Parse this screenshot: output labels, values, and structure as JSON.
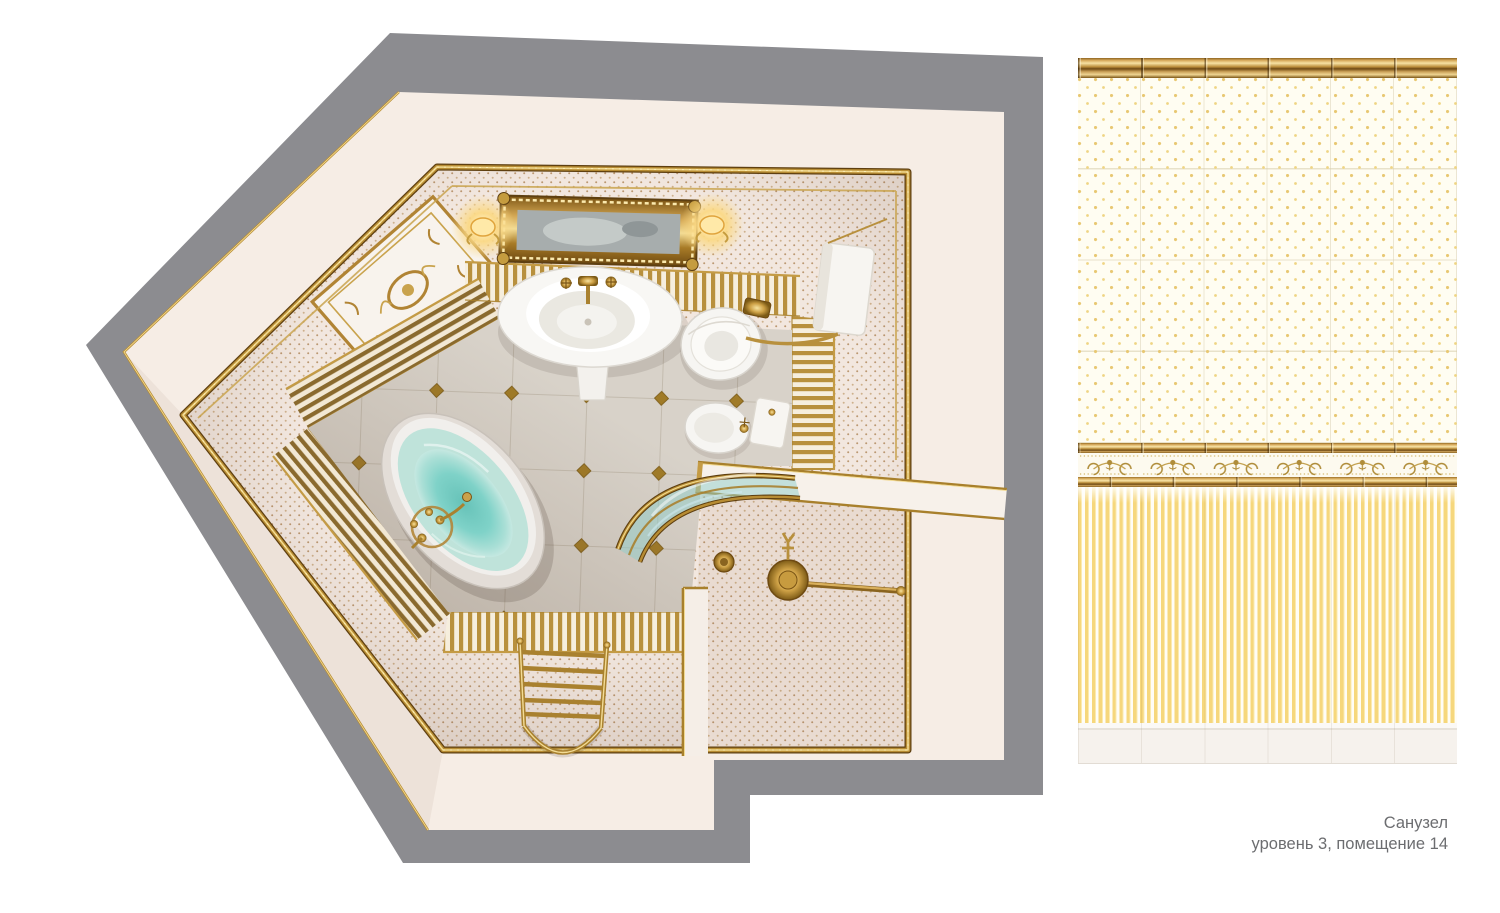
{
  "title_block": {
    "room_name": "Санузел",
    "location": "уровень 3, помещение 14"
  },
  "plan": {
    "type": "top-down-3d-render",
    "room": "bathroom",
    "fixtures": [
      "bathtub",
      "bath-mixer",
      "pedestal-sink",
      "ornate-wall-mirror",
      "sconce-left",
      "sconce-right",
      "toilet",
      "wall-cistern",
      "bidet",
      "shower-enclosure-curved-glass",
      "shower-head",
      "floor-drain",
      "heated-towel-rail",
      "decorative-wall-panel",
      "doorway"
    ]
  },
  "tile_panel": {
    "columns": 6,
    "sections": [
      "gold-molding",
      "dotted-field",
      "ornament-frieze",
      "striped-field",
      "baseboard"
    ]
  },
  "palette": {
    "roof_gray": "#8c8c90",
    "wall_white": "#f6ede5",
    "gold_trim": "#b78c33",
    "gold_dark": "#5e3f10",
    "gold_light": "#f2d98e",
    "wallpaper_bg": "#f2e7df",
    "wallpaper_dot": "#b28a5e",
    "floor_tile": "#d8d2c9",
    "water_teal": "#6ec7bd",
    "tile_cream": "#fffdf2",
    "tile_dot_gold": "#e8c873",
    "stripe_gold": "#f6d77c",
    "caption_gray": "#6c6d70"
  }
}
